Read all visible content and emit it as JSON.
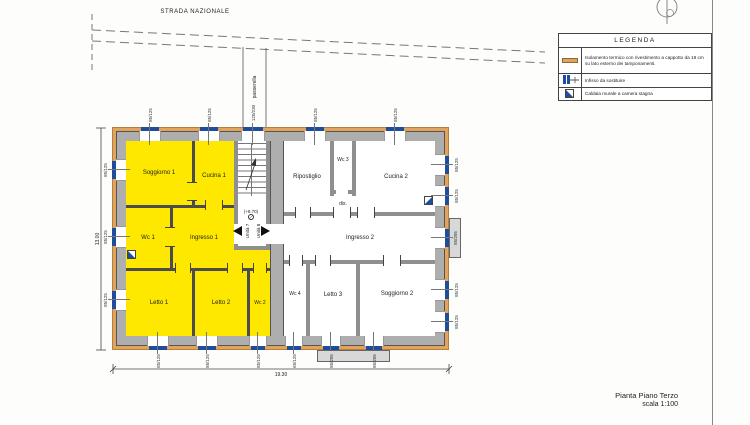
{
  "drawing": {
    "road_label": "STRADA NAZIONALE",
    "walkway_label": "passerella",
    "title_line1": "Pianta Piano Terzo",
    "title_line2": "scala 1:100"
  },
  "legend": {
    "title": "LEGENDA",
    "items": [
      {
        "symbol": "insulation-swatch",
        "text": "Isolamento termico con rivestimento a cappotto da 18 cm su lato esterno dei tamponamenti."
      },
      {
        "symbol": "window-to-replace-symbol",
        "text": "Infisso da sostituire"
      },
      {
        "symbol": "sealed-chamber-boiler-symbol",
        "text": "Caldaia murale a camera stagna"
      }
    ]
  },
  "rooms": {
    "soggiorno1": "Soggiorno 1",
    "cucina1": "Cucina 1",
    "wc1": "Wc 1",
    "ingresso1": "Ingresso 1",
    "letto1": "Letto 1",
    "letto2": "Letto 2",
    "wc2": "Wc 2",
    "ripostiglio": "Ripostiglio",
    "wc3": "Wc 3",
    "dis": "dis.",
    "cucina2": "Cucina 2",
    "ingresso2": "Ingresso 2",
    "wc4": "Wc 4",
    "letto3": "Letto 3",
    "soggiorno2": "Soggiorno 2"
  },
  "stair": {
    "level": "(+8.70)",
    "unit7": "Unità 7",
    "unit8": "Unità 8"
  },
  "dims": {
    "overall_width": "19.30",
    "overall_height": "13.00"
  },
  "windows": {
    "std": "85/125",
    "tall": "85/205",
    "door": "120/230",
    "small": "65/125"
  },
  "colors": {
    "unit_fill": "#ffe800",
    "insulation": "#e2a45c",
    "wall_gray": "#aeaeae",
    "frame_blue": "#1f4d9e",
    "boiler_blue": "#1f4d9e"
  }
}
